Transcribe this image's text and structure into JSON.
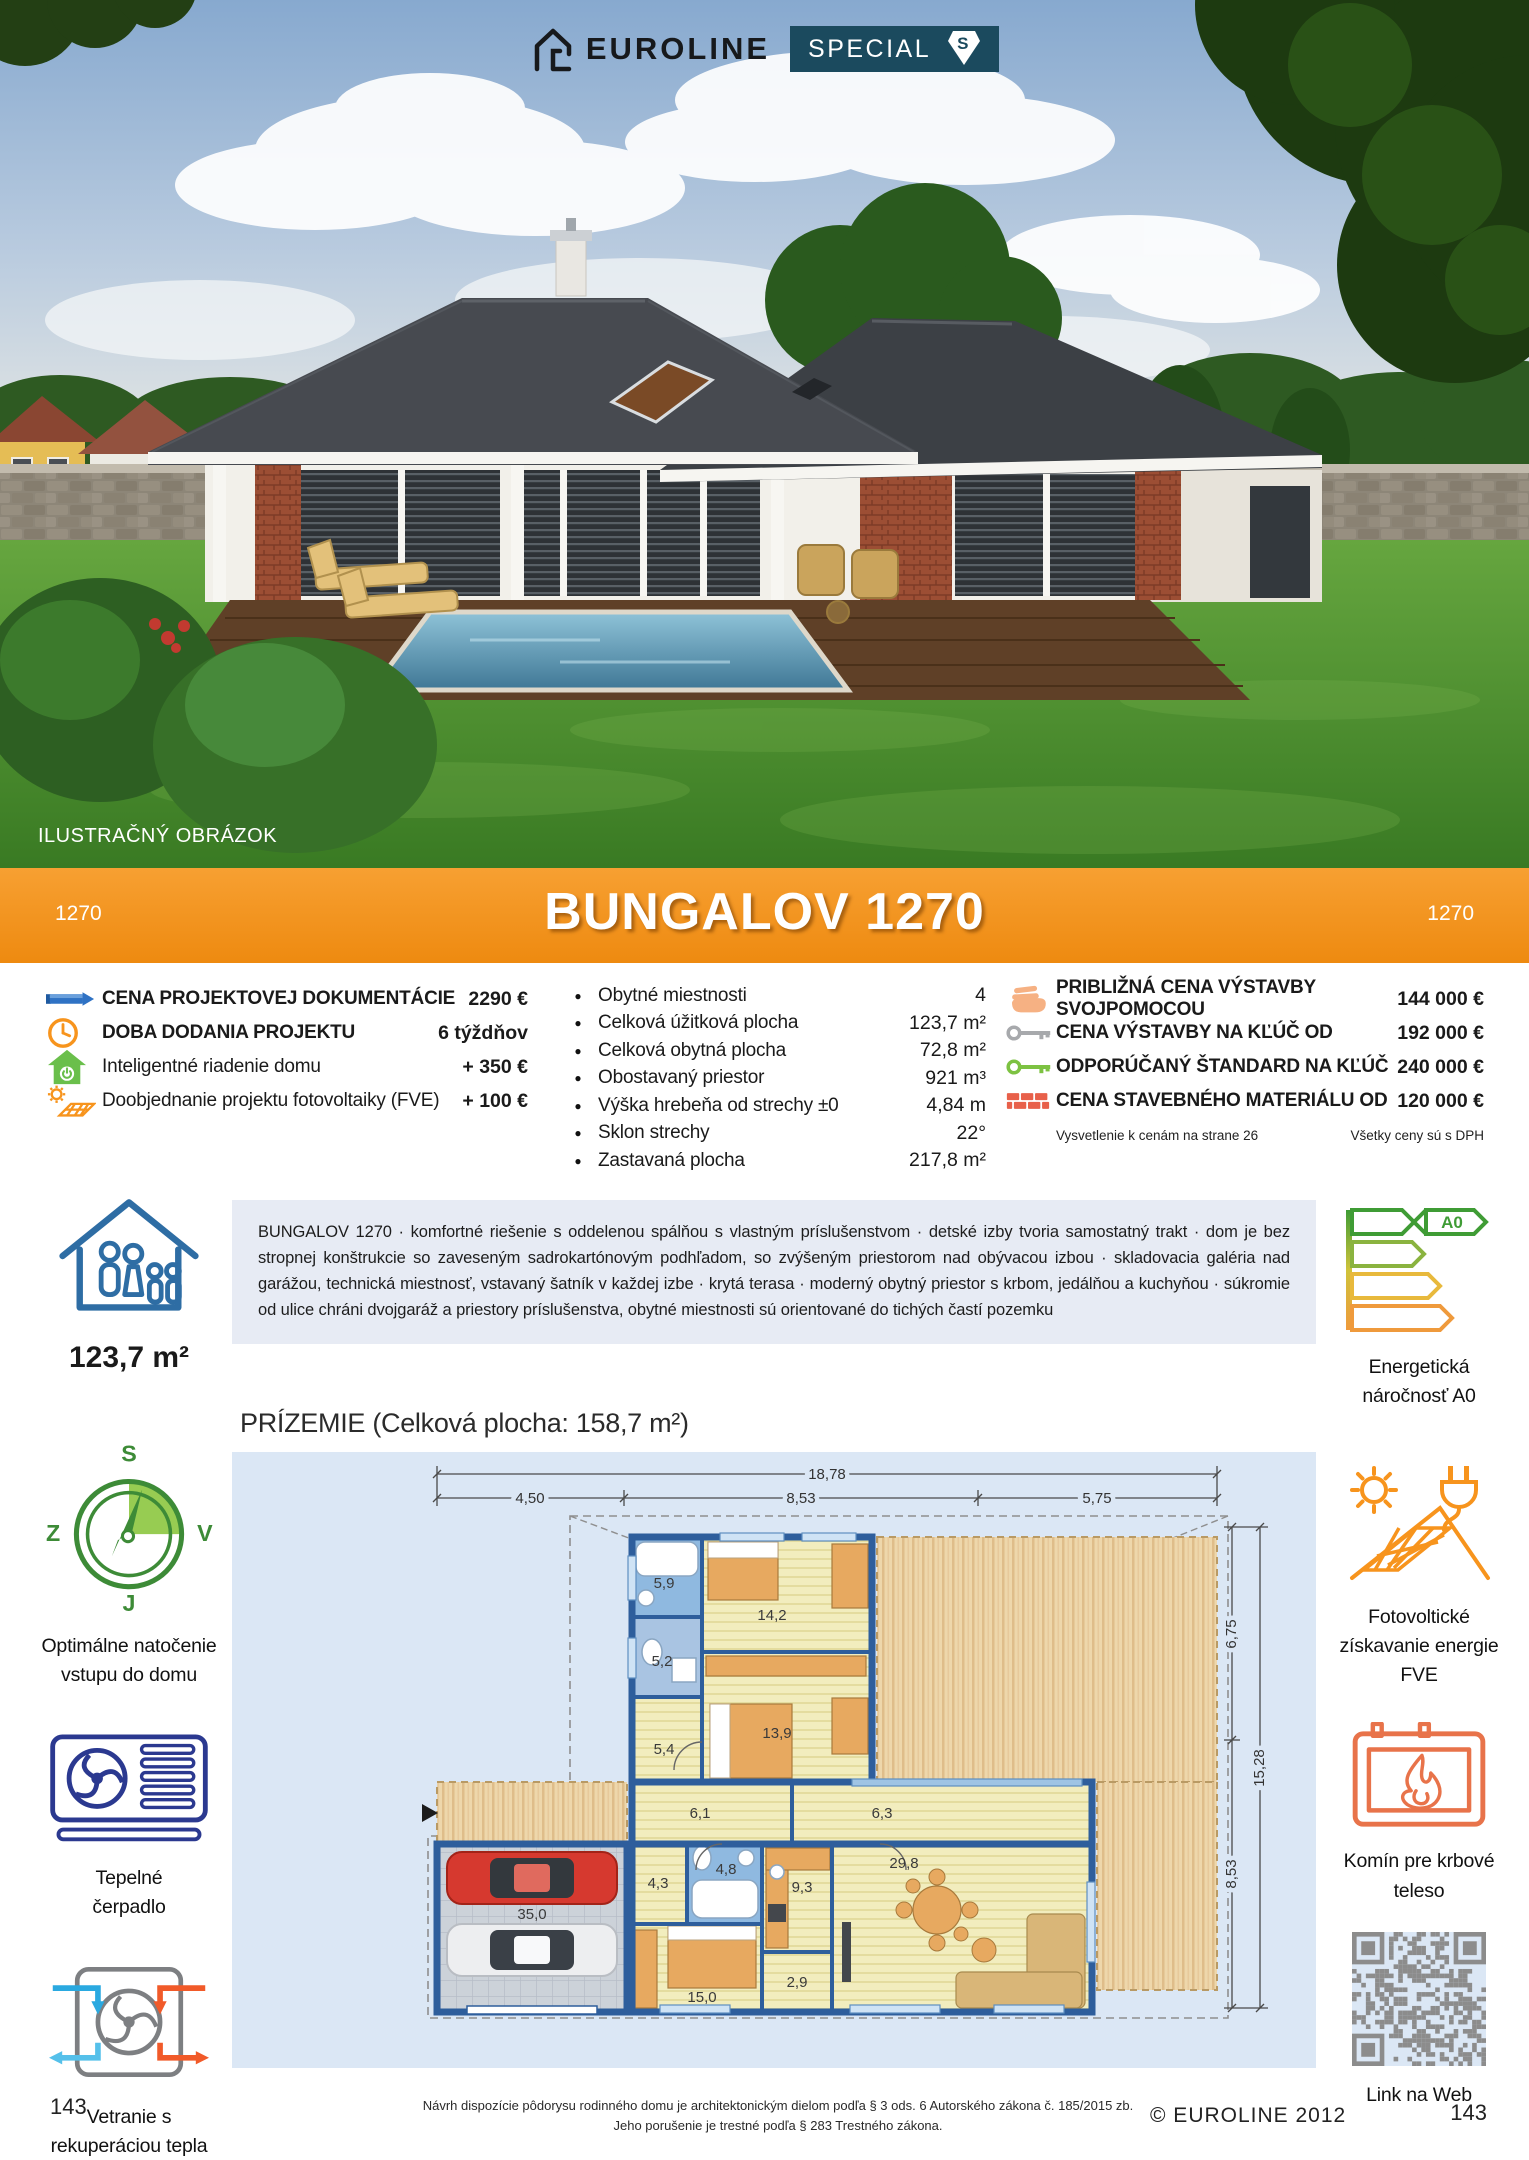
{
  "colors": {
    "banner_orange": "#F3941E",
    "badge_teal": "#1B4A5E",
    "accent_blue": "#2F72C4",
    "navy": "#2B3990",
    "green": "#3D8B37",
    "light_green": "#8CC63F",
    "orange": "#F7941D",
    "brick_red": "#E8604A",
    "key_gray": "#A7A9AC",
    "key_green": "#7DC242",
    "hand_peach": "#F6B183",
    "desc_bg": "#E7EBF4",
    "plan_bg": "#DBE7F5",
    "wall_blue": "#2E5E9C"
  },
  "header": {
    "brand": "EUROLINE",
    "special": "SPECIAL",
    "special_s": "S",
    "photo_caption": "ILUSTRAČNÝ OBRÁZOK"
  },
  "banner": {
    "title": "BUNGALOV 1270",
    "code_left": "1270",
    "code_right": "1270"
  },
  "pricing_left": {
    "rows": [
      {
        "label": "CENA PROJEKTOVEJ DOKUMENTÁCIE",
        "value": "2290 €"
      },
      {
        "label": "DOBA DODANIA PROJEKTU",
        "value": "6 týždňov"
      },
      {
        "label": "Inteligentné riadenie domu",
        "value": "+ 350 €"
      },
      {
        "label": "Doobjednanie projektu fotovoltaiky (FVE)",
        "value": "+ 100 €"
      }
    ]
  },
  "specs": {
    "rows": [
      {
        "label": "Obytné miestnosti",
        "value": "4"
      },
      {
        "label": "Celková úžitková plocha",
        "value": "123,7 m²"
      },
      {
        "label": "Celková obytná plocha",
        "value": "72,8 m²"
      },
      {
        "label": "Obostavaný priestor",
        "value": "921 m³"
      },
      {
        "label": "Výška hrebeňa od strechy ±0",
        "value": "4,84 m"
      },
      {
        "label": "Sklon strechy",
        "value": "22°"
      },
      {
        "label": "Zastavaná plocha",
        "value": "217,8 m²"
      }
    ]
  },
  "pricing_right": {
    "rows": [
      {
        "label": "PRIBLIŽNÁ CENA VÝSTAVBY SVOJPOMOCOU",
        "value": "144 000 €"
      },
      {
        "label": "CENA VÝSTAVBY NA KĽÚČ OD",
        "value": "192 000 €"
      },
      {
        "label": "ODPORÚČANÝ ŠTANDARD NA KĽÚČ",
        "value": "240 000 €"
      },
      {
        "label": "CENA STAVEBNÉHO MATERIÁLU OD",
        "value": "120 000 €"
      }
    ],
    "note_left": "Vysvetlenie k cenám na strane 26",
    "note_right": "Všetky ceny sú s DPH"
  },
  "description": "BUNGALOV 1270 · komfortné riešenie s oddelenou spálňou s vlastným príslušenstvom · detské izby tvoria samostatný trakt · dom je bez stropnej konštrukcie so zaveseným sadrokartónovým podhľadom, so zvýšeným priestorom nad obývacou izbou · skladovacia galéria nad garážou, technická miestnosť, vstavaný šatník v každej izbe · krytá terasa · moderný obytný priestor s krbom, jedálňou a kuchyňou · súkromie od ulice chráni dvojgaráž a priestory príslušenstva, obytné miestnosti sú orientované do tichých častí pozemku",
  "sidebar_left": {
    "area": "123,7 m²",
    "compass": {
      "n": "S",
      "e": "V",
      "s": "J",
      "w": "Z",
      "caption1": "Optimálne natočenie",
      "caption2": "vstupu do domu"
    },
    "heatpump": {
      "caption1": "Tepelné",
      "caption2": "čerpadlo"
    },
    "ventilation": {
      "caption1": "Vetranie s",
      "caption2": "rekuperáciou tepla"
    }
  },
  "sidebar_right": {
    "energy": {
      "badge": "A0",
      "caption1": "Energetická",
      "caption2": "náročnosť A0"
    },
    "pv": {
      "caption1": "Fotovoltické",
      "caption2": "získavanie energie",
      "caption3": "FVE"
    },
    "fireplace": {
      "caption1": "Komín pre krbové",
      "caption2": "teleso"
    },
    "qr": {
      "caption": "Link na Web"
    }
  },
  "floorplan": {
    "heading": "PRÍZEMIE (Celková plocha: 158,7 m²)",
    "dims": {
      "total_w": "18,78",
      "w1": "4,50",
      "w2": "8,53",
      "w3": "5,75",
      "h1": "6,75",
      "h2": "8,53",
      "total_h": "15,28"
    },
    "rooms": [
      "5,9",
      "14,2",
      "5,2",
      "5,4",
      "13,9",
      "6,1",
      "6,3",
      "4,3",
      "4,8",
      "9,3",
      "29,8",
      "35,0",
      "15,0",
      "2,9"
    ]
  },
  "footer": {
    "legal1": "Návrh dispozície pôdorysu rodinného domu je architektonickým dielom podľa § 3 ods. 6 Autorského zákona č. 185/2015 zb.",
    "legal2": "Jeho porušenie je trestné podľa § 283 Trestného zákona.",
    "copyright": "© EUROLINE 2012",
    "page_left": "143",
    "page_right": "143"
  }
}
